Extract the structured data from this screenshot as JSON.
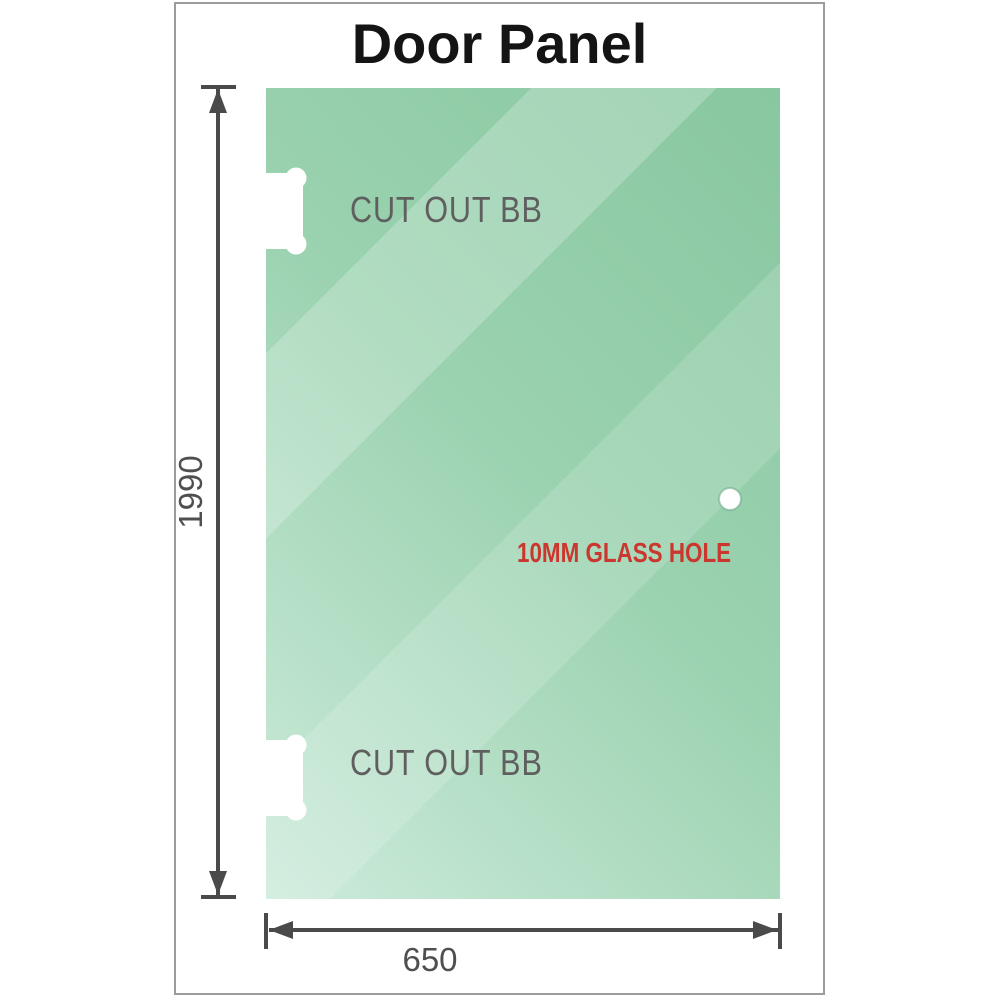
{
  "title": "Door Panel",
  "panel": {
    "cutouts": [
      {
        "label": "CUT OUT BB"
      },
      {
        "label": "CUT OUT BB"
      }
    ],
    "hole": {
      "label": "10MM GLASS HOLE"
    }
  },
  "dimensions": {
    "height": "1990",
    "width": "650"
  },
  "icons": {
    "height_arrow": "double-headed-vertical-dimension-arrow",
    "width_arrow": "double-headed-horizontal-dimension-arrow"
  },
  "colors": {
    "glass_dark": "#88c7a0",
    "glass_mid": "#9bd2b0",
    "glass_light": "#cdebdb",
    "dimension": "#4a4a4a",
    "dimension_text": "#4f4f4f",
    "label_gray": "#5f5f5f",
    "hole_label_red": "#cb372e",
    "title": "#141414",
    "frame_border": "#9c9c9c"
  }
}
